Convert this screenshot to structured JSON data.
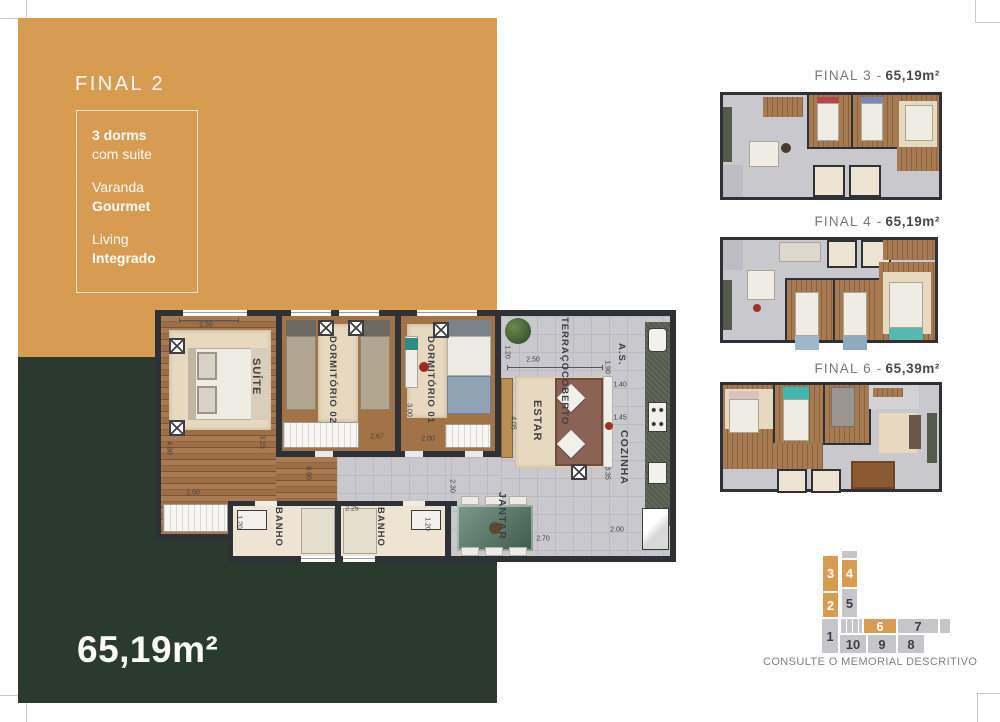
{
  "colors": {
    "orange": "#D89B52",
    "green": "#2B3A2E",
    "wall": "#2E3237",
    "tile": "#C9C8CD",
    "wood": "#9A6845",
    "rug": "#E6D9BF",
    "bath_floor": "#EDE4D3",
    "granite": "#565A4D",
    "label_dark": "#3F3F42",
    "title_gray": "#77777A"
  },
  "left_panel": {
    "title": "FINAL 2",
    "features": [
      {
        "line1": "3 dorms",
        "line2": "com suite"
      },
      {
        "line1": "Varanda",
        "line2": "Gourmet"
      },
      {
        "line1": "Living",
        "line2": "Integrado"
      }
    ],
    "area": "65,19m²"
  },
  "main_plan": {
    "rooms": {
      "suite": "SUÍTE",
      "dorm2": "DORMITÓRIO 02",
      "dorm1": "DORMITÓRIO 01",
      "banho1": "BANHO",
      "banho2": "BANHO",
      "terraco_l1": "TERRAÇO",
      "terraco_l2": "COBERTO",
      "as": "A.S.",
      "estar": "ESTAR",
      "cozinha": "COZINHA",
      "jantar": "JANTAR"
    },
    "dimensions": [
      {
        "t": "2.50",
        "x": 51,
        "y": 15,
        "v": 0
      },
      {
        "t": "4.90",
        "x": 14,
        "y": 138,
        "v": 1
      },
      {
        "t": "3.15",
        "x": 107,
        "y": 132,
        "v": 1
      },
      {
        "t": "1.50",
        "x": 38,
        "y": 183,
        "v": 0
      },
      {
        "t": "0.90",
        "x": 153,
        "y": 163,
        "v": 1
      },
      {
        "t": "2.67",
        "x": 222,
        "y": 127,
        "v": 0
      },
      {
        "t": "3.00",
        "x": 254,
        "y": 100,
        "v": 1
      },
      {
        "t": "2.00",
        "x": 273,
        "y": 129,
        "v": 0
      },
      {
        "t": "1.20",
        "x": 84,
        "y": 212,
        "v": 1
      },
      {
        "t": "2.25",
        "x": 197,
        "y": 199,
        "v": 0
      },
      {
        "t": "1.20",
        "x": 272,
        "y": 214,
        "v": 1
      },
      {
        "t": "1.20",
        "x": 352,
        "y": 42,
        "v": 1
      },
      {
        "t": "2.50",
        "x": 378,
        "y": 50,
        "v": 0
      },
      {
        "t": "1.90",
        "x": 452,
        "y": 57,
        "v": 1
      },
      {
        "t": "4.05",
        "x": 358,
        "y": 113,
        "v": 1
      },
      {
        "t": "1.40",
        "x": 465,
        "y": 75,
        "v": 0
      },
      {
        "t": "1.45",
        "x": 465,
        "y": 108,
        "v": 0
      },
      {
        "t": "3.35",
        "x": 452,
        "y": 163,
        "v": 1
      },
      {
        "t": "2.00",
        "x": 462,
        "y": 220,
        "v": 0
      },
      {
        "t": "2.70",
        "x": 388,
        "y": 229,
        "v": 0
      },
      {
        "t": "2.30",
        "x": 297,
        "y": 176,
        "v": 1
      }
    ]
  },
  "units": [
    {
      "prefix": "FINAL 3 -",
      "area": "65,19m²"
    },
    {
      "prefix": "FINAL 4 -",
      "area": "65,19m²"
    },
    {
      "prefix": "FINAL 6 -",
      "area": "65,39m²"
    }
  ],
  "keyplan": {
    "note": "CONSULTE O MEMORIAL DESCRITIVO",
    "cells": [
      {
        "n": "3",
        "hl": true,
        "x": 7,
        "y": 7,
        "w": 17,
        "h": 37
      },
      {
        "n": "4",
        "hl": true,
        "x": 26,
        "y": 11,
        "w": 17,
        "h": 29
      },
      {
        "n": "2",
        "hl": true,
        "x": 7,
        "y": 44,
        "w": 17,
        "h": 26
      },
      {
        "n": "5",
        "hl": false,
        "x": 26,
        "y": 40,
        "w": 17,
        "h": 30
      },
      {
        "n": "1",
        "hl": false,
        "x": 6,
        "y": 70,
        "w": 18,
        "h": 36
      },
      {
        "n": "6",
        "hl": true,
        "x": 48,
        "y": 70,
        "w": 34,
        "h": 16
      },
      {
        "n": "7",
        "hl": false,
        "x": 82,
        "y": 70,
        "w": 42,
        "h": 16
      },
      {
        "n": "10",
        "hl": false,
        "x": 24,
        "y": 86,
        "w": 28,
        "h": 20
      },
      {
        "n": "9",
        "hl": false,
        "x": 52,
        "y": 86,
        "w": 30,
        "h": 20
      },
      {
        "n": "8",
        "hl": false,
        "x": 82,
        "y": 86,
        "w": 28,
        "h": 20
      }
    ]
  }
}
